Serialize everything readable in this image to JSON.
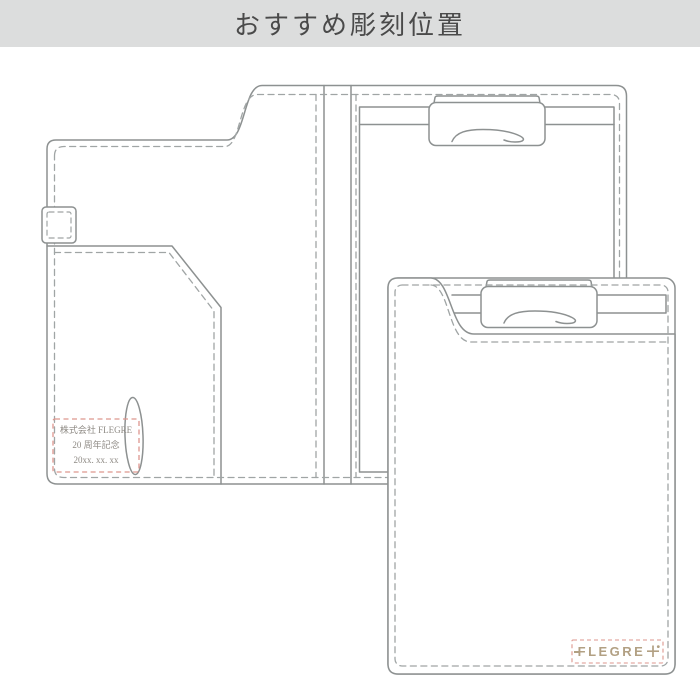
{
  "header": {
    "title": "おすすめ彫刻位置"
  },
  "diagram": {
    "description": "line drawing of clipboard folder, open (left) and closed (right)",
    "engraving_sample": {
      "line1": "株式会社 FLEGRE",
      "line2": "20 周年記念",
      "line3": "20xx. xx. xx"
    },
    "logo": {
      "text": "FLEGRE",
      "plus": "+"
    }
  },
  "colors": {
    "header_bg": "#dcdddd",
    "title_text": "#4a4a4a",
    "outline": "#8d9191",
    "stitch": "#a0a5a5",
    "annotation_red": "#dd968e",
    "engraving_text": "#8e8a84",
    "logo_gold": "#b2a083"
  }
}
